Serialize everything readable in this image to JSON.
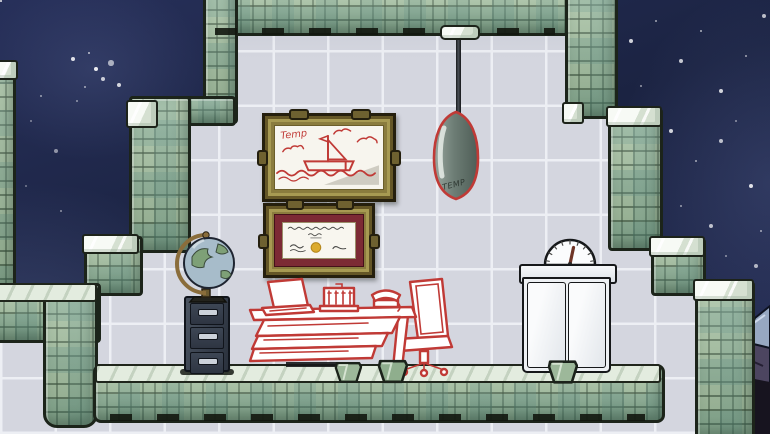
{
  "scene": {
    "title": "Space colony office room",
    "labels": {
      "painting_signature": "Temp",
      "lamp_stamp": "TEMP"
    },
    "colors": {
      "space": "#1d2645",
      "tile": "#d4d6df",
      "grout": "#edeff4",
      "rock": "#a3bf9f",
      "rock_dark": "#1c241a",
      "accent_red": "#c03a36",
      "frame_gold": "#8a7c3e",
      "mat_maroon": "#7c2a34",
      "seal_gold": "#dcab2e",
      "cabinet_slate": "#3a4250",
      "pendant_gray": "#6d7d75",
      "crystal_light": "#97a8c2",
      "crystal_dark": "#17141f"
    },
    "objects": [
      {
        "name": "landscape-painting",
        "desc": "framed placeholder sketch of a sailboat"
      },
      {
        "name": "certificate-painting",
        "desc": "framed diploma with gold seal"
      },
      {
        "name": "pendant-lamp",
        "desc": "hanging lamp with TEMP placeholder art"
      },
      {
        "name": "desk-globe",
        "desc": "world globe on brass stand"
      },
      {
        "name": "file-cabinet",
        "desc": "three-drawer filing cabinet"
      },
      {
        "name": "desk-blueprint",
        "desc": "planned desk with laptop, adding machine and telephone"
      },
      {
        "name": "chair-blueprint",
        "desc": "planned office chair"
      },
      {
        "name": "refrigerator",
        "desc": "white cooler with pressure gauge"
      },
      {
        "name": "debris-chunk",
        "desc": "green mineral chunk on floor"
      },
      {
        "name": "crystal-formation",
        "desc": "dark crystalline rock at lower right"
      }
    ]
  }
}
